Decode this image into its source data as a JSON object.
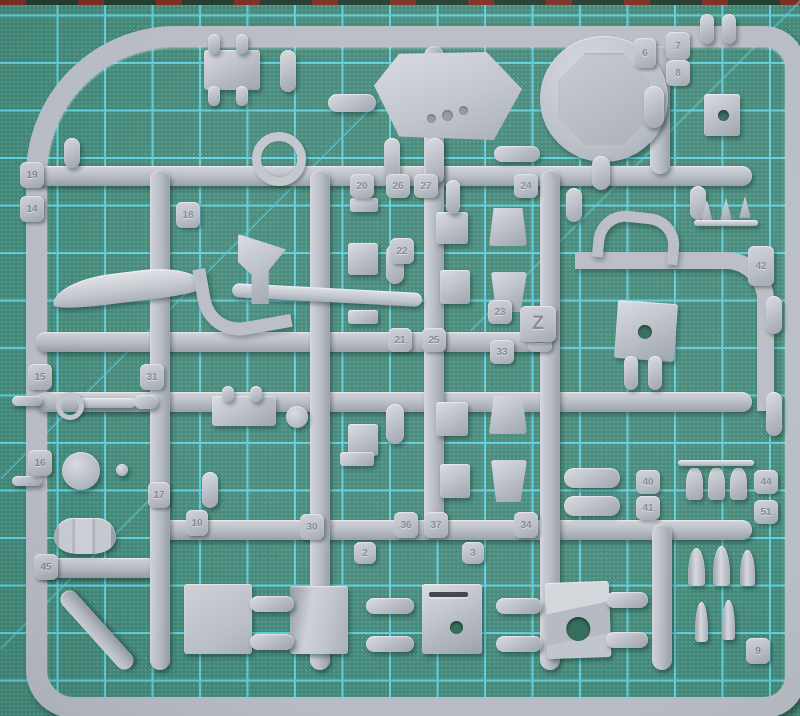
{
  "scene": {
    "description": "Photograph of a grey styrene model-kit sprue (parts frame) lying on a green self-healing cutting mat with cyan grid lines",
    "sprue_letter": "Z",
    "plastic_color_name": "light grey"
  },
  "colors": {
    "mat_base": "#3f8877",
    "mat_grid": "#58cbdc",
    "mat_hole": "#2f6b59",
    "mat_edge_dark": "#223c30",
    "mat_edge_red": "#7e2d22",
    "plastic_base": "#b8bcc4",
    "plastic_light": "#d8dbe0",
    "plastic_dark": "#9aa0aa"
  },
  "mat": {
    "grid_spacing_px": 47.5,
    "grid_offset_px": 11,
    "diagonals": [
      {
        "x": 0,
        "y": 478,
        "len": 560,
        "rot": -45
      },
      {
        "x": 470,
        "y": 330,
        "len": 470,
        "rot": -45
      },
      {
        "x": 0,
        "y": 648,
        "len": 230,
        "rot": -45
      }
    ]
  },
  "runners": [
    {
      "x": 36,
      "y": 166,
      "w": 716,
      "h": 20
    },
    {
      "x": 36,
      "y": 332,
      "w": 520,
      "h": 20
    },
    {
      "x": 36,
      "y": 392,
      "w": 716,
      "h": 20
    },
    {
      "x": 150,
      "y": 520,
      "w": 602,
      "h": 20
    },
    {
      "x": 36,
      "y": 558,
      "w": 122,
      "h": 20
    },
    {
      "x": 150,
      "y": 170,
      "w": 20,
      "h": 500
    },
    {
      "x": 310,
      "y": 170,
      "w": 20,
      "h": 500
    },
    {
      "x": 424,
      "y": 46,
      "w": 20,
      "h": 488
    },
    {
      "x": 540,
      "y": 170,
      "w": 20,
      "h": 500
    },
    {
      "x": 650,
      "y": 46,
      "w": 20,
      "h": 128
    },
    {
      "x": 652,
      "y": 524,
      "w": 20,
      "h": 146
    },
    {
      "x": 88,
      "y": 580,
      "w": 18,
      "h": 100,
      "rot": -42
    }
  ],
  "parts": [
    {
      "n": "equipment-box",
      "cls": "rect",
      "x": 204,
      "y": 50,
      "w": 56,
      "h": 40
    },
    {
      "n": "peg",
      "cls": "pill",
      "x": 208,
      "y": 34,
      "w": 12,
      "h": 20
    },
    {
      "n": "peg",
      "cls": "pill",
      "x": 236,
      "y": 34,
      "w": 12,
      "h": 20
    },
    {
      "n": "peg",
      "cls": "pill",
      "x": 208,
      "y": 86,
      "w": 12,
      "h": 20
    },
    {
      "n": "peg",
      "cls": "pill",
      "x": 236,
      "y": 86,
      "w": 12,
      "h": 20
    },
    {
      "n": "cylinder",
      "cls": "pill",
      "x": 328,
      "y": 94,
      "w": 48,
      "h": 18
    },
    {
      "n": "cylinder",
      "cls": "pill",
      "x": 280,
      "y": 50,
      "w": 16,
      "h": 42
    },
    {
      "n": "cylinder",
      "cls": "pill",
      "x": 494,
      "y": 146,
      "w": 46,
      "h": 16
    },
    {
      "n": "turret-roof-plate",
      "cls": "hex clip",
      "x": 374,
      "y": 52,
      "w": 148,
      "h": 88
    },
    {
      "n": "periscope-dot",
      "cls": "dot",
      "x": 427,
      "y": 114,
      "w": 9,
      "h": 9
    },
    {
      "n": "periscope-dot",
      "cls": "dot",
      "x": 442,
      "y": 110,
      "w": 11,
      "h": 11
    },
    {
      "n": "periscope-dot",
      "cls": "dot",
      "x": 459,
      "y": 106,
      "w": 9,
      "h": 9
    },
    {
      "n": "round-hatch-disc",
      "cls": "disc",
      "x": 540,
      "y": 36,
      "w": 128,
      "h": 126,
      "inner": true
    },
    {
      "n": "stem",
      "cls": "pill",
      "x": 384,
      "y": 138,
      "w": 16,
      "h": 42
    },
    {
      "n": "stem",
      "cls": "pill",
      "x": 426,
      "y": 138,
      "w": 18,
      "h": 46
    },
    {
      "n": "stem",
      "cls": "pill",
      "x": 592,
      "y": 156,
      "w": 18,
      "h": 34
    },
    {
      "n": "stem",
      "cls": "pill",
      "x": 644,
      "y": 86,
      "w": 20,
      "h": 42
    },
    {
      "n": "peg",
      "cls": "pill",
      "x": 700,
      "y": 14,
      "w": 14,
      "h": 30
    },
    {
      "n": "peg",
      "cls": "pill",
      "x": 722,
      "y": 14,
      "w": 14,
      "h": 30
    },
    {
      "n": "clamp-block",
      "cls": "hb",
      "x": 704,
      "y": 94,
      "w": 36,
      "h": 42,
      "hole": [
        55,
        50,
        11
      ]
    },
    {
      "n": "ring-part",
      "cls": "ring",
      "x": 252,
      "y": 132,
      "w": 36,
      "h": 36
    },
    {
      "n": "stem",
      "cls": "pill",
      "x": 64,
      "y": 138,
      "w": 16,
      "h": 30
    },
    {
      "n": "wing-blade",
      "cls": "blade",
      "x": 52,
      "y": 272,
      "w": 152,
      "h": 30,
      "rot": -7
    },
    {
      "n": "tow-hook",
      "cls": "hook",
      "x": 198,
      "y": 262,
      "w": 76,
      "h": 60,
      "rot": -10
    },
    {
      "n": "barrel-blade",
      "cls": "thin",
      "x": 232,
      "y": 288,
      "w": 190,
      "h": 14,
      "rot": 3
    },
    {
      "n": "flag-bracket",
      "cls": "flag clip",
      "x": 238,
      "y": 234,
      "w": 48,
      "h": 70
    },
    {
      "n": "flat-bar",
      "cls": "rect",
      "x": 350,
      "y": 198,
      "w": 28,
      "h": 14
    },
    {
      "n": "block",
      "cls": "rect",
      "x": 348,
      "y": 243,
      "w": 30,
      "h": 32
    },
    {
      "n": "block",
      "cls": "rect",
      "x": 436,
      "y": 212,
      "w": 32,
      "h": 32
    },
    {
      "n": "block",
      "cls": "rect",
      "x": 440,
      "y": 270,
      "w": 30,
      "h": 34
    },
    {
      "n": "flat-bar",
      "cls": "rect",
      "x": 348,
      "y": 310,
      "w": 30,
      "h": 14
    },
    {
      "n": "wedge",
      "cls": "trap clip",
      "x": 489,
      "y": 208,
      "w": 38,
      "h": 38
    },
    {
      "n": "wedge",
      "cls": "trapm clip",
      "x": 491,
      "y": 272,
      "w": 36,
      "h": 40
    },
    {
      "n": "stem",
      "cls": "pill",
      "x": 386,
      "y": 244,
      "w": 18,
      "h": 40
    },
    {
      "n": "stem",
      "cls": "pill",
      "x": 446,
      "y": 180,
      "w": 14,
      "h": 34
    },
    {
      "n": "stem",
      "cls": "pill",
      "x": 566,
      "y": 188,
      "w": 16,
      "h": 34
    },
    {
      "n": "stem",
      "cls": "pill",
      "x": 690,
      "y": 186,
      "w": 16,
      "h": 34
    },
    {
      "n": "block",
      "cls": "rect",
      "x": 348,
      "y": 424,
      "w": 30,
      "h": 32
    },
    {
      "n": "block",
      "cls": "rect",
      "x": 436,
      "y": 402,
      "w": 32,
      "h": 34
    },
    {
      "n": "block",
      "cls": "rect",
      "x": 440,
      "y": 464,
      "w": 30,
      "h": 34
    },
    {
      "n": "flat-bar",
      "cls": "rect",
      "x": 340,
      "y": 452,
      "w": 34,
      "h": 14
    },
    {
      "n": "wedge",
      "cls": "trap clip",
      "x": 489,
      "y": 396,
      "w": 38,
      "h": 38
    },
    {
      "n": "wedge",
      "cls": "trapm clip",
      "x": 491,
      "y": 460,
      "w": 36,
      "h": 42
    },
    {
      "n": "stem",
      "cls": "pill",
      "x": 386,
      "y": 404,
      "w": 18,
      "h": 40
    },
    {
      "n": "equipment-box",
      "cls": "rect",
      "x": 212,
      "y": 396,
      "w": 64,
      "h": 30
    },
    {
      "n": "peg",
      "cls": "pill",
      "x": 222,
      "y": 386,
      "w": 12,
      "h": 16
    },
    {
      "n": "peg",
      "cls": "pill",
      "x": 250,
      "y": 386,
      "w": 12,
      "h": 16
    },
    {
      "n": "small-wheel",
      "cls": "circle",
      "x": 286,
      "y": 406,
      "w": 22,
      "h": 22
    },
    {
      "n": "machine-gun-barrel",
      "cls": "thin",
      "x": 78,
      "y": 398,
      "w": 58,
      "h": 10
    },
    {
      "n": "ring-sight",
      "cls": "ring2",
      "x": 56,
      "y": 392,
      "w": 18,
      "h": 18
    },
    {
      "n": "gun-body",
      "cls": "pill",
      "x": 134,
      "y": 395,
      "w": 24,
      "h": 14
    },
    {
      "n": "road-wheel",
      "cls": "circle",
      "x": 62,
      "y": 452,
      "w": 38,
      "h": 38
    },
    {
      "n": "ball-knob",
      "cls": "circle",
      "x": 116,
      "y": 464,
      "w": 12,
      "h": 12
    },
    {
      "n": "stem",
      "cls": "pill",
      "x": 202,
      "y": 472,
      "w": 16,
      "h": 36
    },
    {
      "n": "fuel-drum",
      "cls": "drum",
      "x": 54,
      "y": 518,
      "w": 62,
      "h": 36
    },
    {
      "n": "side-pin",
      "cls": "pill",
      "x": 12,
      "y": 396,
      "w": 30,
      "h": 10
    },
    {
      "n": "side-pin",
      "cls": "pill",
      "x": 12,
      "y": 476,
      "w": 30,
      "h": 10
    },
    {
      "n": "gun-mantlet",
      "cls": "hb",
      "x": 616,
      "y": 302,
      "w": 60,
      "h": 58,
      "rot": 4,
      "hole": [
        48,
        52,
        14
      ]
    },
    {
      "n": "stem",
      "cls": "pill",
      "x": 624,
      "y": 356,
      "w": 14,
      "h": 34
    },
    {
      "n": "stem",
      "cls": "pill",
      "x": 648,
      "y": 356,
      "w": 14,
      "h": 34
    },
    {
      "n": "saddle-clamp",
      "cls": "arch",
      "x": 594,
      "y": 212,
      "w": 64,
      "h": 38,
      "rot": 6
    },
    {
      "n": "cone-tip",
      "cls": "cone clip",
      "x": 700,
      "y": 200,
      "w": 14,
      "h": 22
    },
    {
      "n": "cone-tip",
      "cls": "cone clip",
      "x": 719,
      "y": 198,
      "w": 14,
      "h": 22
    },
    {
      "n": "cone-tip",
      "cls": "cone clip",
      "x": 738,
      "y": 196,
      "w": 14,
      "h": 22
    },
    {
      "n": "cone-rod",
      "cls": "thin",
      "x": 694,
      "y": 220,
      "w": 64,
      "h": 6
    },
    {
      "n": "roller",
      "cls": "pill",
      "x": 564,
      "y": 468,
      "w": 56,
      "h": 20
    },
    {
      "n": "roller",
      "cls": "pill",
      "x": 564,
      "y": 496,
      "w": 56,
      "h": 20
    },
    {
      "n": "bottle",
      "cls": "bottle",
      "x": 686,
      "y": 468,
      "w": 17,
      "h": 32
    },
    {
      "n": "bottle",
      "cls": "bottle",
      "x": 708,
      "y": 468,
      "w": 17,
      "h": 32
    },
    {
      "n": "bottle",
      "cls": "bottle",
      "x": 730,
      "y": 468,
      "w": 17,
      "h": 32
    },
    {
      "n": "bottle-rod",
      "cls": "thin",
      "x": 678,
      "y": 460,
      "w": 76,
      "h": 6
    },
    {
      "n": "ammo-shell",
      "cls": "bullet",
      "x": 688,
      "y": 548,
      "w": 17,
      "h": 38
    },
    {
      "n": "ammo-shell",
      "cls": "bullet",
      "x": 713,
      "y": 546,
      "w": 17,
      "h": 40
    },
    {
      "n": "ammo-shell",
      "cls": "bullet",
      "x": 740,
      "y": 550,
      "w": 15,
      "h": 36
    },
    {
      "n": "ammo-shell",
      "cls": "bullet",
      "x": 695,
      "y": 602,
      "w": 13,
      "h": 40
    },
    {
      "n": "ammo-shell",
      "cls": "bullet",
      "x": 722,
      "y": 600,
      "w": 13,
      "h": 40
    },
    {
      "n": "side-pill",
      "cls": "pill",
      "x": 766,
      "y": 296,
      "w": 16,
      "h": 38
    },
    {
      "n": "side-pill",
      "cls": "pill",
      "x": 766,
      "y": 392,
      "w": 16,
      "h": 44
    },
    {
      "n": "hull-panel",
      "cls": "panel",
      "x": 184,
      "y": 584,
      "w": 68,
      "h": 70
    },
    {
      "n": "curved-panel",
      "cls": "panelc",
      "x": 290,
      "y": 586,
      "w": 58,
      "h": 68
    },
    {
      "n": "slotted-panel",
      "cls": "hb",
      "x": 422,
      "y": 584,
      "w": 60,
      "h": 70,
      "hole": [
        58,
        62,
        13
      ],
      "slot": true
    },
    {
      "n": "angled-bracket",
      "cls": "hb bracket",
      "x": 546,
      "y": 582,
      "w": 64,
      "h": 76,
      "rot": -2,
      "hole": [
        50,
        62,
        24
      ]
    },
    {
      "n": "gate",
      "cls": "pill",
      "x": 250,
      "y": 596,
      "w": 44,
      "h": 16
    },
    {
      "n": "gate",
      "cls": "pill",
      "x": 250,
      "y": 634,
      "w": 44,
      "h": 16
    },
    {
      "n": "gate",
      "cls": "pill",
      "x": 366,
      "y": 598,
      "w": 48,
      "h": 16
    },
    {
      "n": "gate",
      "cls": "pill",
      "x": 366,
      "y": 636,
      "w": 48,
      "h": 16
    },
    {
      "n": "gate",
      "cls": "pill",
      "x": 496,
      "y": 598,
      "w": 46,
      "h": 16
    },
    {
      "n": "gate",
      "cls": "pill",
      "x": 496,
      "y": 636,
      "w": 46,
      "h": 16
    },
    {
      "n": "gate",
      "cls": "pill",
      "x": 606,
      "y": 592,
      "w": 42,
      "h": 16
    },
    {
      "n": "gate",
      "cls": "pill",
      "x": 606,
      "y": 632,
      "w": 42,
      "h": 16
    }
  ],
  "tabs": [
    {
      "label": "19",
      "x": 20,
      "y": 162,
      "w": 24,
      "h": 26
    },
    {
      "label": "14",
      "x": 20,
      "y": 196,
      "w": 24,
      "h": 26
    },
    {
      "label": "18",
      "x": 176,
      "y": 202,
      "w": 24,
      "h": 26
    },
    {
      "label": "15",
      "x": 28,
      "y": 364,
      "w": 24,
      "h": 26
    },
    {
      "label": "31",
      "x": 140,
      "y": 364,
      "w": 24,
      "h": 26
    },
    {
      "label": "16",
      "x": 28,
      "y": 450,
      "w": 24,
      "h": 26
    },
    {
      "label": "17",
      "x": 148,
      "y": 482,
      "w": 22,
      "h": 26
    },
    {
      "label": "10",
      "x": 186,
      "y": 510,
      "w": 22,
      "h": 26
    },
    {
      "label": "45",
      "x": 34,
      "y": 554,
      "w": 24,
      "h": 26
    },
    {
      "label": "6",
      "x": 634,
      "y": 38,
      "w": 22,
      "h": 30
    },
    {
      "label": "7",
      "x": 666,
      "y": 32,
      "w": 24,
      "h": 28
    },
    {
      "label": "8",
      "x": 666,
      "y": 60,
      "w": 24,
      "h": 26
    },
    {
      "label": "20",
      "x": 350,
      "y": 174,
      "w": 24,
      "h": 24
    },
    {
      "label": "26",
      "x": 386,
      "y": 174,
      "w": 24,
      "h": 24
    },
    {
      "label": "27",
      "x": 414,
      "y": 174,
      "w": 24,
      "h": 24
    },
    {
      "label": "24",
      "x": 514,
      "y": 174,
      "w": 24,
      "h": 24
    },
    {
      "label": "22",
      "x": 390,
      "y": 238,
      "w": 24,
      "h": 26
    },
    {
      "label": "21",
      "x": 388,
      "y": 328,
      "w": 24,
      "h": 24
    },
    {
      "label": "25",
      "x": 422,
      "y": 328,
      "w": 24,
      "h": 24
    },
    {
      "label": "28",
      "x": 528,
      "y": 328,
      "w": 24,
      "h": 24
    },
    {
      "label": "23",
      "x": 488,
      "y": 300,
      "w": 24,
      "h": 24
    },
    {
      "label": "Z",
      "x": 520,
      "y": 306,
      "w": 36,
      "h": 36,
      "big": true
    },
    {
      "label": "33",
      "x": 490,
      "y": 340,
      "w": 24,
      "h": 24
    },
    {
      "label": "30",
      "x": 300,
      "y": 514,
      "w": 24,
      "h": 26
    },
    {
      "label": "36",
      "x": 394,
      "y": 512,
      "w": 24,
      "h": 26
    },
    {
      "label": "37",
      "x": 424,
      "y": 512,
      "w": 24,
      "h": 26
    },
    {
      "label": "34",
      "x": 514,
      "y": 512,
      "w": 24,
      "h": 26
    },
    {
      "label": "2",
      "x": 354,
      "y": 542,
      "w": 22,
      "h": 22
    },
    {
      "label": "3",
      "x": 462,
      "y": 542,
      "w": 22,
      "h": 22
    },
    {
      "label": "42",
      "x": 748,
      "y": 246,
      "w": 26,
      "h": 40
    },
    {
      "label": "40",
      "x": 636,
      "y": 470,
      "w": 24,
      "h": 24
    },
    {
      "label": "41",
      "x": 636,
      "y": 496,
      "w": 24,
      "h": 24
    },
    {
      "label": "44",
      "x": 754,
      "y": 470,
      "w": 24,
      "h": 24
    },
    {
      "label": "51",
      "x": 754,
      "y": 500,
      "w": 24,
      "h": 24
    },
    {
      "label": "9",
      "x": 746,
      "y": 638,
      "w": 24,
      "h": 26
    }
  ]
}
